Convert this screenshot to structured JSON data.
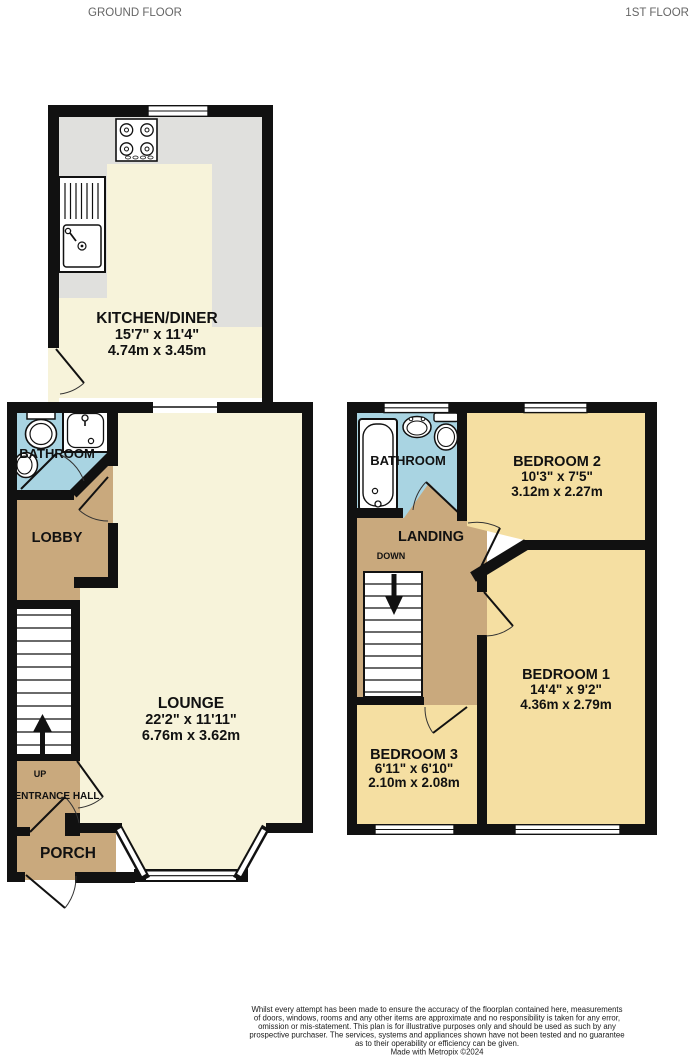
{
  "header": {
    "ground_floor_label": "GROUND FLOOR",
    "first_floor_label": "1ST FLOOR"
  },
  "ground_floor": {
    "kitchen": {
      "name": "KITCHEN/DINER",
      "imperial": "15'7\" x 11'4\"",
      "metric": "4.74m x 3.45m"
    },
    "bathroom": {
      "name": "BATHROOM"
    },
    "lobby": {
      "name": "LOBBY"
    },
    "lounge": {
      "name": "LOUNGE",
      "imperial": "22'2\" x 11'11\"",
      "metric": "6.76m x 3.62m"
    },
    "up_label": "UP",
    "entrance_hall": {
      "name": "ENTRANCE HALL"
    },
    "porch": {
      "name": "PORCH"
    }
  },
  "first_floor": {
    "bathroom": {
      "name": "BATHROOM"
    },
    "bedroom2": {
      "name": "BEDROOM 2",
      "imperial": "10'3\" x 7'5\"",
      "metric": "3.12m x 2.27m"
    },
    "landing": {
      "name": "LANDING"
    },
    "down_label": "DOWN",
    "bedroom1": {
      "name": "BEDROOM 1",
      "imperial": "14'4\" x 9'2\"",
      "metric": "4.36m x 2.79m"
    },
    "bedroom3": {
      "name": "BEDROOM 3",
      "imperial": "6'11\" x 6'10\"",
      "metric": "2.10m x 2.08m"
    }
  },
  "footer": {
    "lines": [
      "Whilst every attempt has been made to ensure the accuracy of the floorplan contained here, measurements",
      "of doors, windows, rooms and any other items are approximate and no responsibility is taken for any error,",
      "omission or mis-statement. This plan is for illustrative purposes only and should be used as such by any",
      "prospective purchaser. The services, systems and appliances shown have not been tested and no guarantee",
      "as to their operability or efficiency can be given.",
      "Made with Metropix ©2024"
    ]
  },
  "colors": {
    "wall": "#111111",
    "floor_cream": "#f7f3da",
    "room_tan": "#c9a97d",
    "bathroom_blue": "#a9d4e2",
    "bedroom_yellow": "#f5dfa2",
    "counter_gray": "#e0e0dd",
    "header_gray": "#666666"
  }
}
